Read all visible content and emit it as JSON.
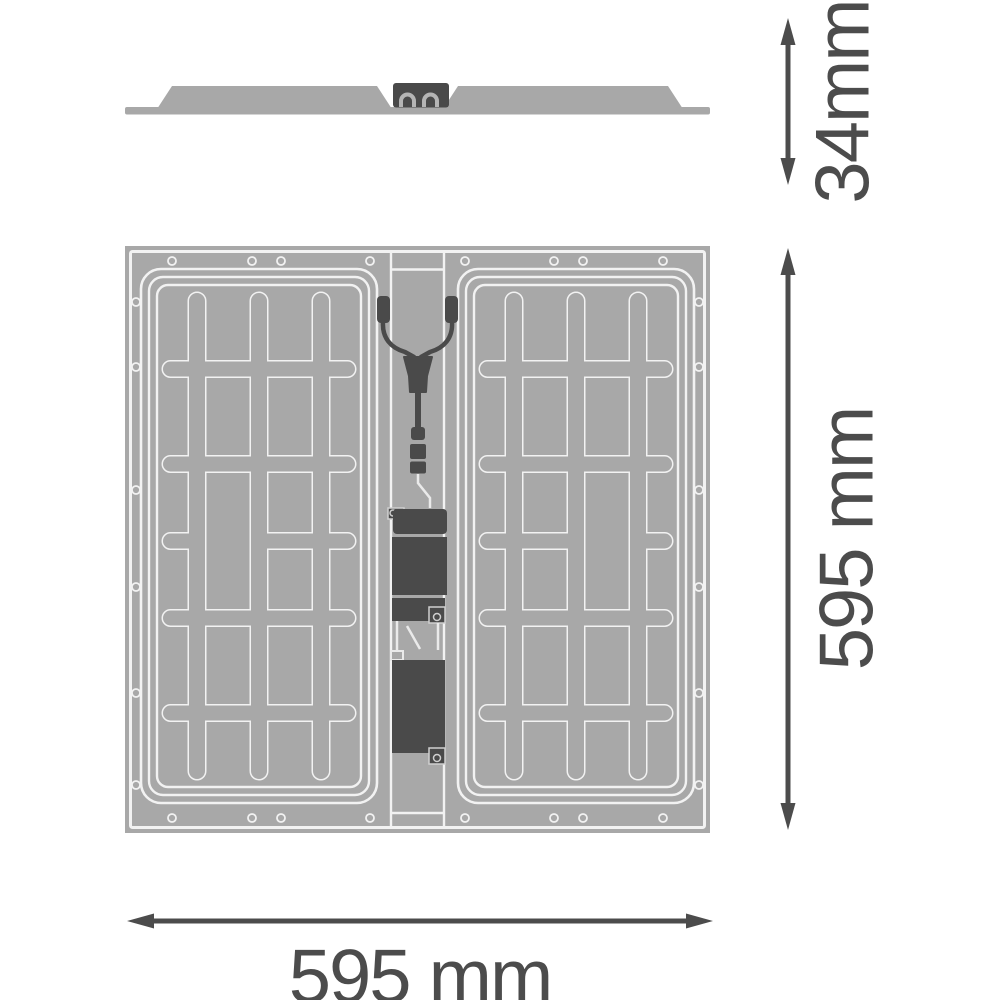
{
  "dimensions": {
    "side_view_height": "34mm",
    "top_view_height": "595 mm",
    "top_view_width": "595 mm"
  },
  "colors": {
    "background": "#ffffff",
    "panel_gray": "#a8a8a8",
    "outline_light": "#f2f2f2",
    "component_dark": "#4a4a4a",
    "dimension_gray": "#4c4c4c"
  }
}
